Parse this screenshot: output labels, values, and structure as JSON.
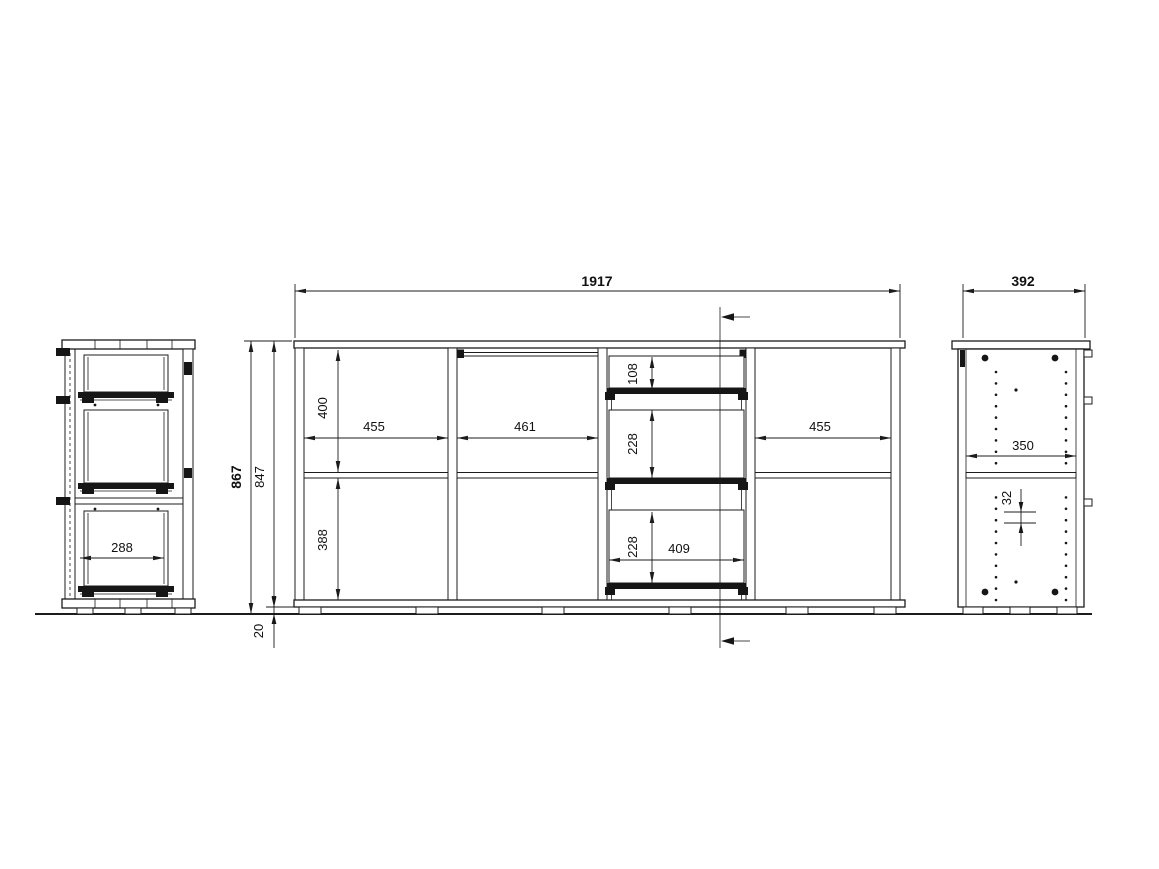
{
  "drawing": {
    "background": "#ffffff",
    "line_color": "#1c1c1c",
    "views": {
      "left": "left-side-section-view",
      "center": "front-elevation-view",
      "right": "right-side-panel-view"
    },
    "dims": {
      "total_width": "1917",
      "depth": "392",
      "total_height": "867",
      "body_height": "847",
      "plinth_height": "20",
      "left_compartment_width": "455",
      "middle_compartment_width": "461",
      "right_compartment_width": "455",
      "upper_section_height": "400",
      "lower_section_height": "388",
      "drawer_top_height": "108",
      "drawer_middle_height": "228",
      "drawer_bottom_height": "228",
      "drawer_inner_width": "409",
      "drawer_inner_depth": "288",
      "shelf_depth": "350",
      "hole_pitch": "32"
    }
  }
}
